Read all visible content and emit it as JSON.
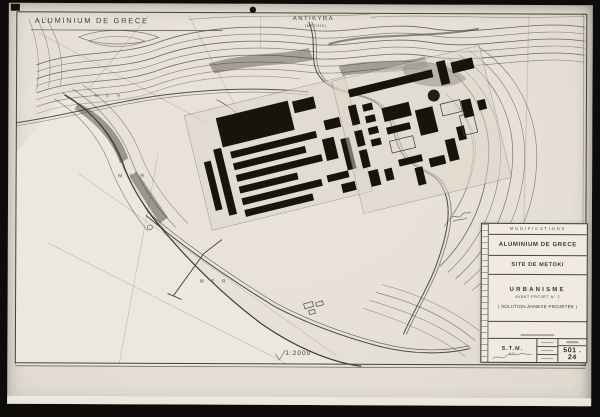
{
  "map": {
    "corner_title": "ALUMINIUM DE GRECE",
    "north_label": "ANTIKYRA",
    "north_sublabel": "(METOHI)",
    "sea_label_1": "M E R",
    "sea_label_2": "M E R",
    "sea_label_3": "M E R",
    "scale": "1:2000"
  },
  "title_block": {
    "header": "MODIFICATIONS",
    "company": "ALUMINIUM DE GRECE",
    "site": "SITE DE METOKI",
    "discipline": "URBANISME",
    "project": "AVANT PROJET N° 2",
    "variant": "( SOLUTION ANNEXE PROJETÉE )",
    "firm": "S.T.M.",
    "firm_sub": "A.G.",
    "number": "501 . 24"
  },
  "colors": {
    "backdrop": "#0d0c0a",
    "paper": "#e6e0d7",
    "ink": "#3b382f",
    "building": "#17140e",
    "sea": "#ece7df",
    "label_paper": "#f0eae1"
  }
}
